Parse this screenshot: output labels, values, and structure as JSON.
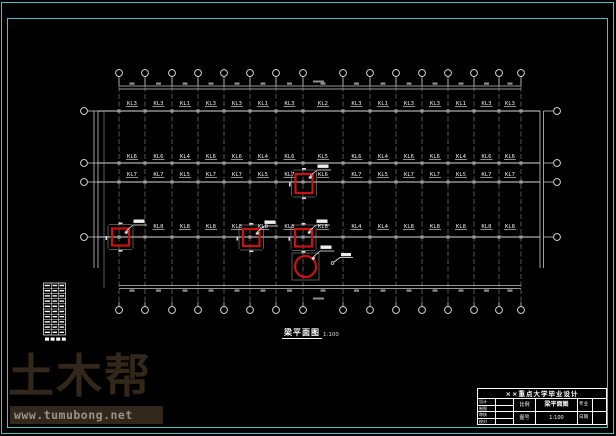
{
  "app": {
    "background": "#000000",
    "frame_color": "#3fc6c6"
  },
  "drawing": {
    "plan_title": "梁平面图",
    "plan_scale": "1:100",
    "highlight_color": "#cc1111",
    "beam_label_rows": [
      {
        "labels": [
          "KL3",
          "KL3",
          "KL1",
          "KL3",
          "KL3",
          "KL1",
          "KL3",
          "KL2",
          "KL3",
          "KL1",
          "KL3",
          "KL3",
          "KL1",
          "KL3",
          "KL3"
        ]
      },
      {
        "labels": [
          "KL6",
          "KL6",
          "KL4",
          "KL6",
          "KL6",
          "KL4",
          "KL6",
          "KL5",
          "KL6",
          "KL4",
          "KL6",
          "KL6",
          "KL4",
          "KL6",
          "KL6"
        ]
      },
      {
        "labels": [
          "KL7",
          "KL7",
          "KL5",
          "KL7",
          "KL7",
          "KL5",
          "KL7",
          "KL6",
          "KL7",
          "KL5",
          "KL7",
          "KL7",
          "KL5",
          "KL7",
          "KL7"
        ]
      },
      {
        "labels": [
          "",
          "KL8",
          "KL8",
          "KL8",
          "KL8",
          "KL8",
          "KL8",
          "KL8",
          "KL4",
          "KL4",
          "KL8",
          "KL8",
          "KL8",
          "KL8",
          "KL8"
        ]
      }
    ]
  },
  "watermark": {
    "brand": "土木帮",
    "url": "www.tumubong.net",
    "brand_color": "#33261b",
    "url_text_color": "#9c9388"
  },
  "title_block": {
    "project_title": "××重点大学毕业设计",
    "left_rows": [
      "设计",
      "制图",
      "审核",
      "校对"
    ],
    "mid_rows": [
      "比例",
      "图号"
    ],
    "drawing_name": "梁平面图",
    "drawing_scale": "1:100",
    "right_rows": [
      "专业",
      "日期"
    ]
  }
}
